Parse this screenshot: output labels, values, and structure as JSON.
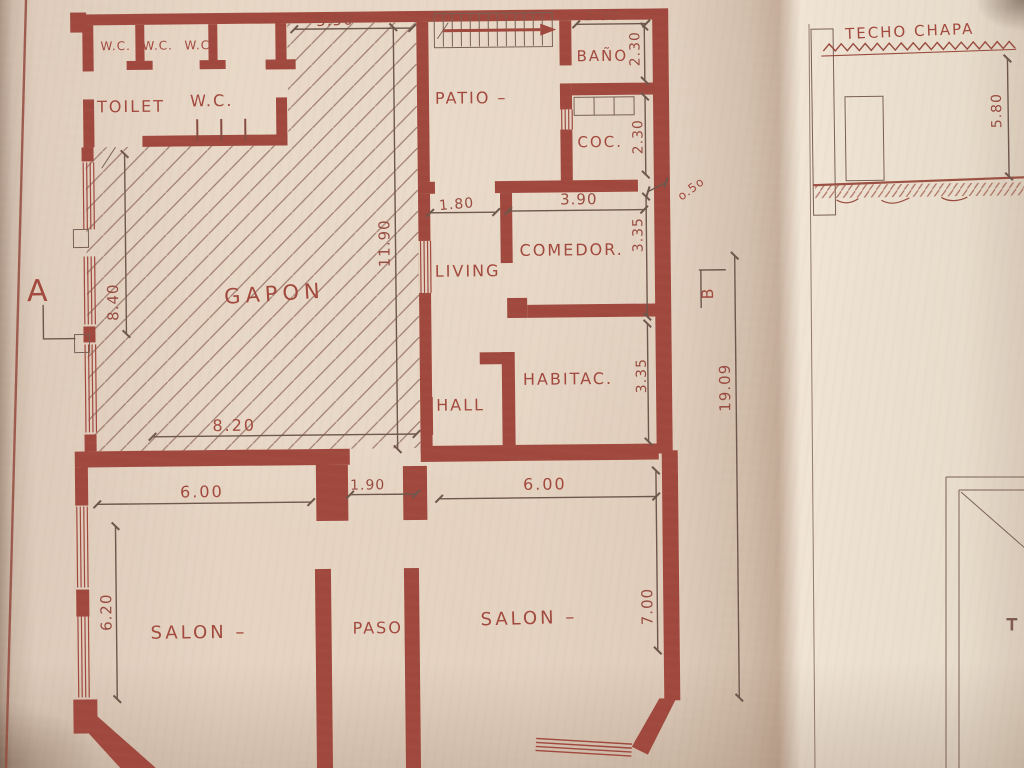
{
  "rooms": {
    "stall1": "W.C.",
    "stall2": "W.C.",
    "stall3": "W.C.",
    "toilet": "TOILET",
    "wc": "W.C.",
    "galpon": "GAPON",
    "patio": "PATIO –",
    "bano": "BAÑO",
    "coc": "COC.",
    "living": "LIVING",
    "comedor": "COMEDOR.",
    "habitac": "HABITAC.",
    "hall": "HALL",
    "salon_left": "SALON –",
    "paso": "PASO",
    "salon_right": "SALON –"
  },
  "dimensions": {
    "top_galpon": "5.50",
    "top_bano": "2.30",
    "bano_h": "2.30",
    "coc_h": "2.30",
    "living_door": "1.80",
    "comedor_w": "3.90",
    "offset": "o.5o",
    "galpon_h": "11.90",
    "galpon_left_h": "8.40",
    "galpon_w": "8.20",
    "comedor_h": "3.35",
    "habitac_h": "3.35",
    "total_h": "19.09",
    "salon_left_w": "6.00",
    "paso_w": "1.90",
    "salon_right_w": "6.00",
    "salon_left_h": "6.20",
    "salon_right_h": "7.00"
  },
  "markers": {
    "section_a": "A",
    "section_b": "B"
  },
  "side_drawing": {
    "title": "TECHO CHAPA",
    "height": "5.80",
    "partial_label": "T"
  },
  "ink": {
    "wall_red": "#a6463a",
    "text_red": "#a8473b",
    "pencil": "#6f564b"
  }
}
